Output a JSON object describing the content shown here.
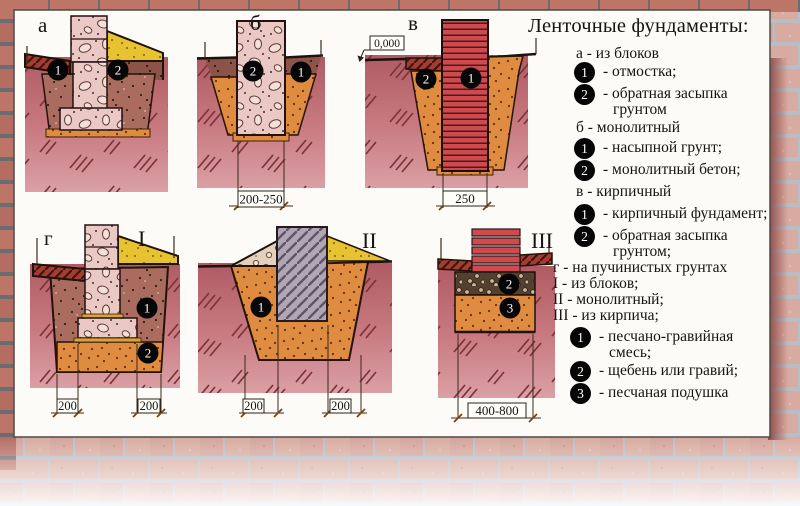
{
  "legend": {
    "title": "Ленточные фундаменты:",
    "a_heading": "а - из блоков",
    "a_i1_num": "1",
    "a_i1": "- отмостка;",
    "a_i2_num": "2",
    "a_i2_line1": "- обратная засыпка",
    "a_i2_line2": "грунтом",
    "b_heading": "б - монолитный",
    "b_i1_num": "1",
    "b_i1": "- насыпной грунт;",
    "b_i2_num": "2",
    "b_i2": "- монолитный бетон;",
    "v_heading": "в - кирпичный",
    "v_i1_num": "1",
    "v_i1": "- кирпичный фундамент;",
    "v_i2_num": "2",
    "v_i2_line1": "- обратная засыпка",
    "v_i2_line2": "грунтом;",
    "g_h1": "г - на пучинистых грунтах",
    "g_h2": "I - из блоков;",
    "g_h3": "II - монолитный;",
    "g_h4": "III - из кирпича;",
    "g_i1_num": "1",
    "g_i1_line1": "- песчано-гравийная",
    "g_i1_line2": "смесь;",
    "g_i2_num": "2",
    "g_i2": "- щебень или гравий;",
    "g_i3_num": "3",
    "g_i3": "- песчаная подушка"
  },
  "diagrams": {
    "a": {
      "label": "а",
      "m1": "1",
      "m2": "2"
    },
    "b": {
      "label": "б",
      "m1": "1",
      "m2": "2",
      "dim": "200-250"
    },
    "v": {
      "label": "в",
      "level": "0,000",
      "m1": "1",
      "m2": "2",
      "dim": "250"
    },
    "g": {
      "label": "г",
      "labelI": "I",
      "m1": "1",
      "m2": "2",
      "dim_left": "200",
      "dim_right": "200"
    },
    "ii": {
      "label": "II",
      "m1": "1",
      "dim_left": "200",
      "dim_right": "200"
    },
    "iii": {
      "label": "III",
      "m2": "2",
      "m3": "3",
      "dim": "400-800"
    }
  },
  "colors": {
    "brick_red": "#ce4a4f",
    "sand_yellow": "#e8c331",
    "gravel_orange": "#df8b40",
    "soil_pink": "#c97b82",
    "marker": "#000000",
    "panel_shadow": "#8a4340"
  }
}
